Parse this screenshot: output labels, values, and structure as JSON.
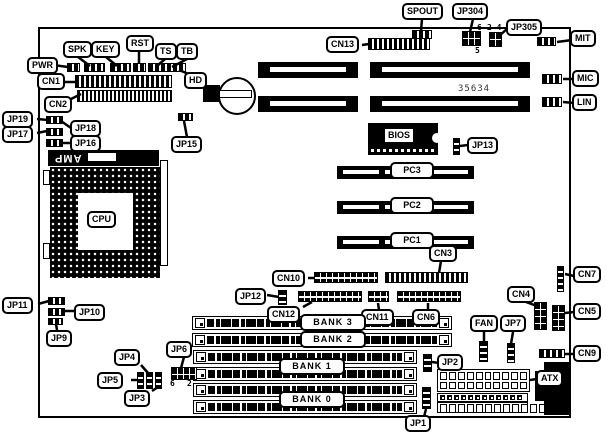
{
  "board": {
    "chip_marking": "35634",
    "cpu_label": "CPU",
    "cpu_socket_brand": "AMP"
  },
  "labels": {
    "pwr": "PWR",
    "spk": "SPK",
    "key": "KEY",
    "rst": "RST",
    "ts": "TS",
    "tb": "TB",
    "hd": "HD",
    "cn1": "CN1",
    "cn2": "CN2",
    "cn13": "CN13",
    "spout": "SPOUT",
    "jp304": "JP304",
    "jp305": "JP305",
    "mit": "MIT",
    "mic": "MIC",
    "lin": "LIN",
    "jp19": "JP19",
    "jp18": "JP18",
    "jp17": "JP17",
    "jp16": "JP16",
    "jp15": "JP15",
    "bios": "BIOS",
    "jp13": "JP13",
    "pc3": "PC3",
    "pc2": "PC2",
    "pc1": "PC1",
    "cn3": "CN3",
    "cn10": "CN10",
    "jp12": "JP12",
    "cn12": "CN12",
    "cn11": "CN11",
    "cn6": "CN6",
    "jp11": "JP11",
    "jp10": "JP10",
    "jp9": "JP9",
    "bank3": "BANK 3",
    "bank2": "BANK 2",
    "bank1": "BANK 1",
    "bank0": "BANK 0",
    "jp6": "JP6",
    "jp4": "JP4",
    "jp5": "JP5",
    "jp3": "JP3",
    "fan": "FAN",
    "jp7": "JP7",
    "cn4": "CN4",
    "cn7": "CN7",
    "cn5": "CN5",
    "cn9": "CN9",
    "jp2": "JP2",
    "atx": "ATX",
    "jp1": "JP1"
  },
  "pin_numbers": {
    "jp304_pin6": "6",
    "jp304_pin5": "5",
    "jp305_pins": "2 4",
    "jp6_pin6": "6",
    "jp6_pin2": "2"
  }
}
